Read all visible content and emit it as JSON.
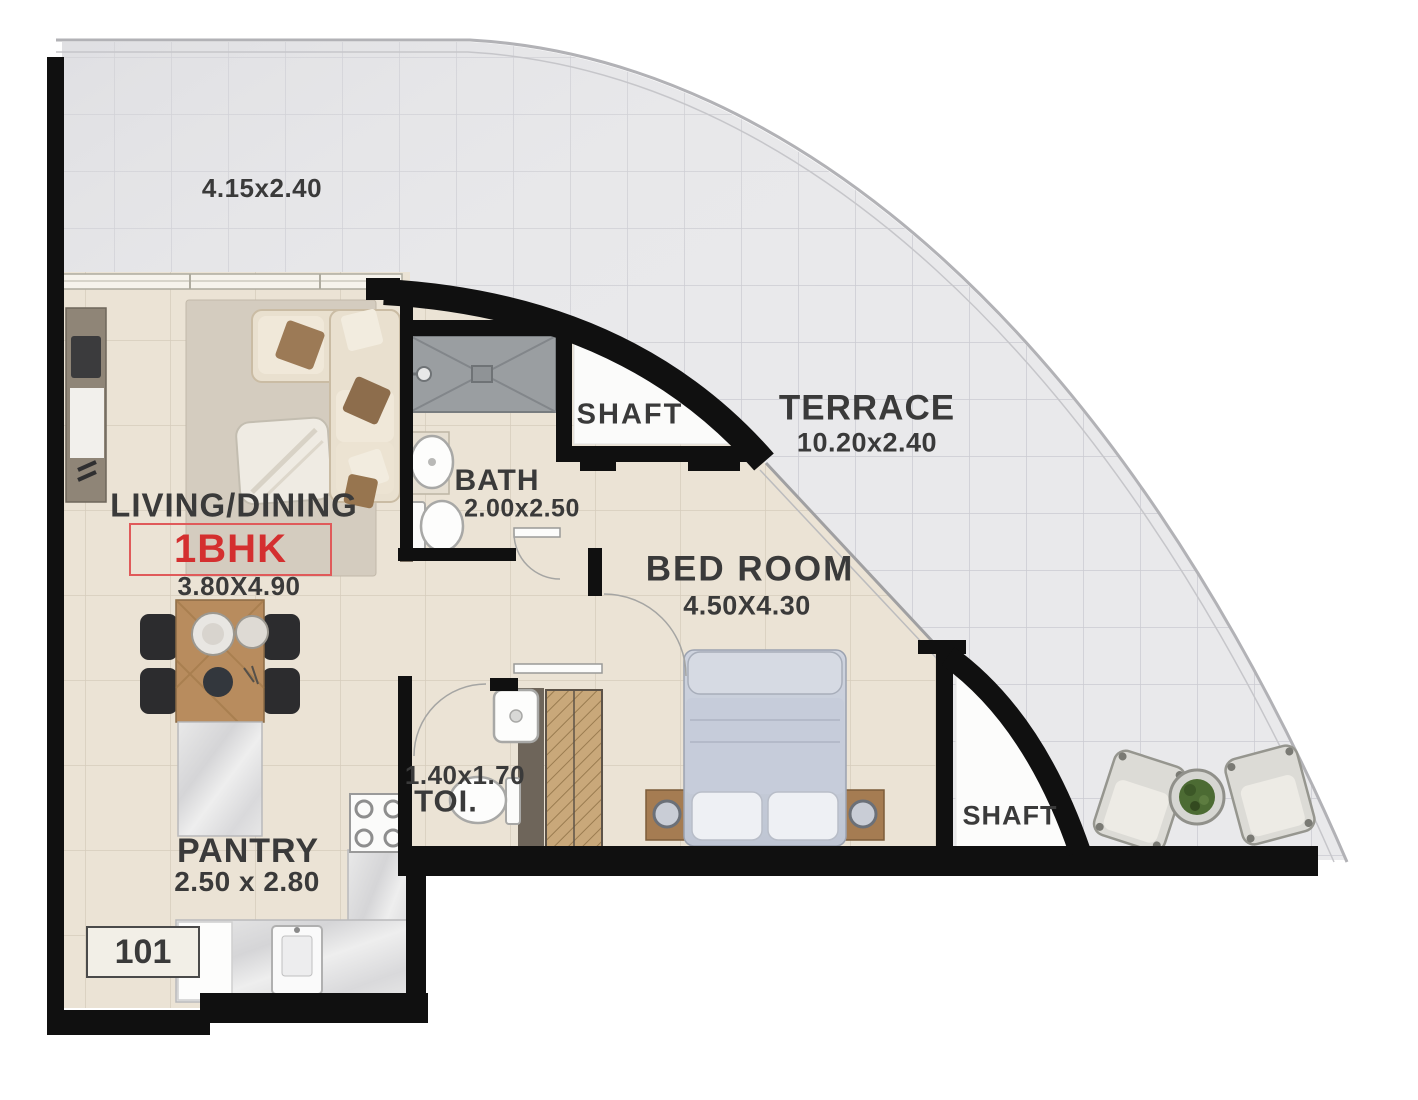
{
  "unit": {
    "type_label": "1BHK",
    "number": "101"
  },
  "rooms": {
    "terrace_upper": {
      "dim": "4.15x2.40"
    },
    "terrace": {
      "label": "TERRACE",
      "dim": "10.20x2.40"
    },
    "living": {
      "label": "LIVING/DINING",
      "dim": "3.80X4.90"
    },
    "bath": {
      "label": "BATH",
      "dim": "2.00x2.50"
    },
    "shaft_top": {
      "label": "SHAFT"
    },
    "bedroom": {
      "label": "BED ROOM",
      "dim": "4.50X4.30"
    },
    "toilet": {
      "label": "TOI.",
      "dim": "1.40x1.70"
    },
    "shaft_bottom": {
      "label": "SHAFT"
    },
    "pantry": {
      "label": "PANTRY",
      "dim": "2.50 x 2.80"
    }
  },
  "colors": {
    "accent_red": "#d42f2f",
    "wall_black": "#101010",
    "terrace_tile": "#e9e9eb",
    "floor_tile": "#ebe3d5"
  }
}
